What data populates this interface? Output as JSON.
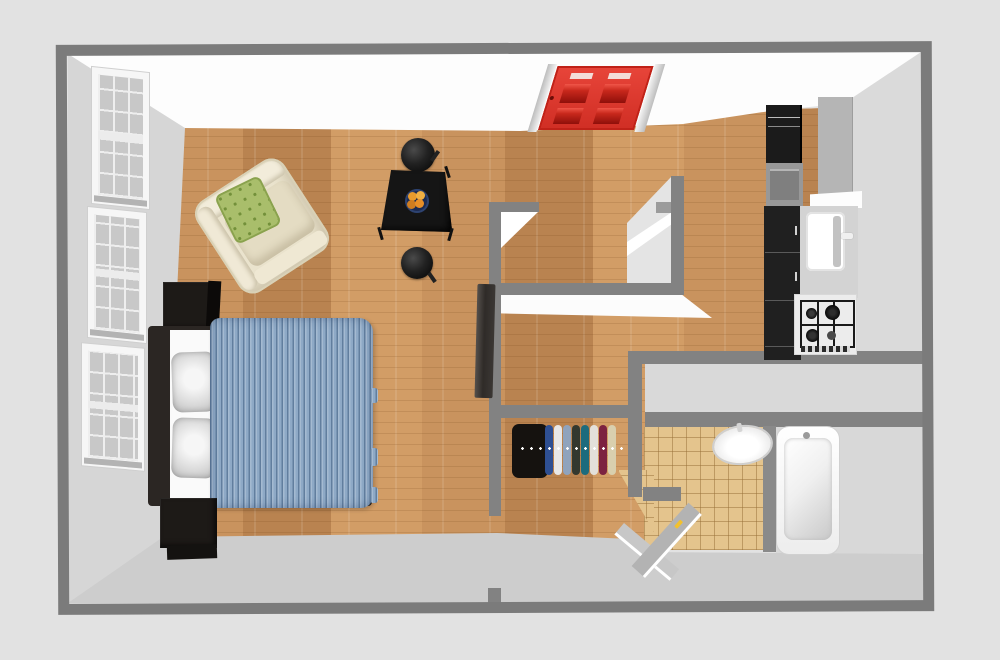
{
  "app": {
    "name": "floor-plan-viewer",
    "view": "3d-top-down-render"
  },
  "palette": {
    "background": "#e2e2e2",
    "outer_wall": "#7b7b7b",
    "interior_wall": "#828282",
    "wall_face_light": "#d6d6d6",
    "wall_face_white": "#fdfdfd",
    "wood_floor": "#c68f59",
    "tile_floor": "#e4c48d",
    "entry_door_red": "#d8352b",
    "duvet_blue": "#8ea9c6",
    "throw_pillow_green": "#a9be6b",
    "armchair_cream": "#eae3cd",
    "appliance_black": "#1b1b1b",
    "fixture_white": "#ffffff",
    "door_handle_yellow": "#f2c12e"
  },
  "scene": {
    "building": {
      "type": "studio-apartment",
      "walls": "gray",
      "window_wall": "left",
      "window_count": 3
    },
    "rooms": [
      {
        "id": "living-bedroom",
        "label": "Living / bedroom",
        "floor": "wood"
      },
      {
        "id": "entry-hall",
        "label": "Entry hall",
        "floor": "wood"
      },
      {
        "id": "kitchen",
        "label": "Kitchen",
        "floor": "wood"
      },
      {
        "id": "closet-hall",
        "label": "Closet hall",
        "floor": "wood"
      },
      {
        "id": "bathroom",
        "label": "Bathroom",
        "floor": "tile"
      }
    ]
  },
  "furniture": {
    "entry_door": {
      "label": "Red entry door",
      "state": "closed",
      "panels": 4,
      "lites": 2
    },
    "armchair": {
      "label": "Cream armchair with green patterned pillow"
    },
    "dining_table": {
      "label": "Black dining table"
    },
    "fruit_bowl": {
      "label": "Bowl of fruit",
      "fruit_count": 4
    },
    "stool_top": {
      "label": "Black round stool"
    },
    "stool_bottom": {
      "label": "Black round stool"
    },
    "bed": {
      "label": "Double bed, blue striped duvet",
      "pillows": 2
    },
    "nightstand_top": {
      "label": "Dark nightstand"
    },
    "nightstand_bottom": {
      "label": "Dark nightstand"
    },
    "hall_door": {
      "label": "Dark interior door, open"
    },
    "clothes_rack": {
      "label": "Closet clothes rack",
      "garments": 9
    },
    "refrigerator": {
      "label": "Refrigerator / tall black unit"
    },
    "oven": {
      "label": "Oven"
    },
    "base_cabinets": {
      "label": "Black base cabinets"
    },
    "upper_cabinet": {
      "label": "Gray cabinet block"
    },
    "kitchen_sink": {
      "label": "Kitchen sink"
    },
    "cooktop": {
      "label": "4-burner gas cooktop"
    },
    "wash_basin": {
      "label": "Bathroom wash basin"
    },
    "bathtub": {
      "label": "Bathtub"
    },
    "bathroom_door": {
      "label": "Bathroom door, open",
      "handle_color": "yellow"
    },
    "closet_door": {
      "label": "Gray door leaf, open"
    }
  }
}
